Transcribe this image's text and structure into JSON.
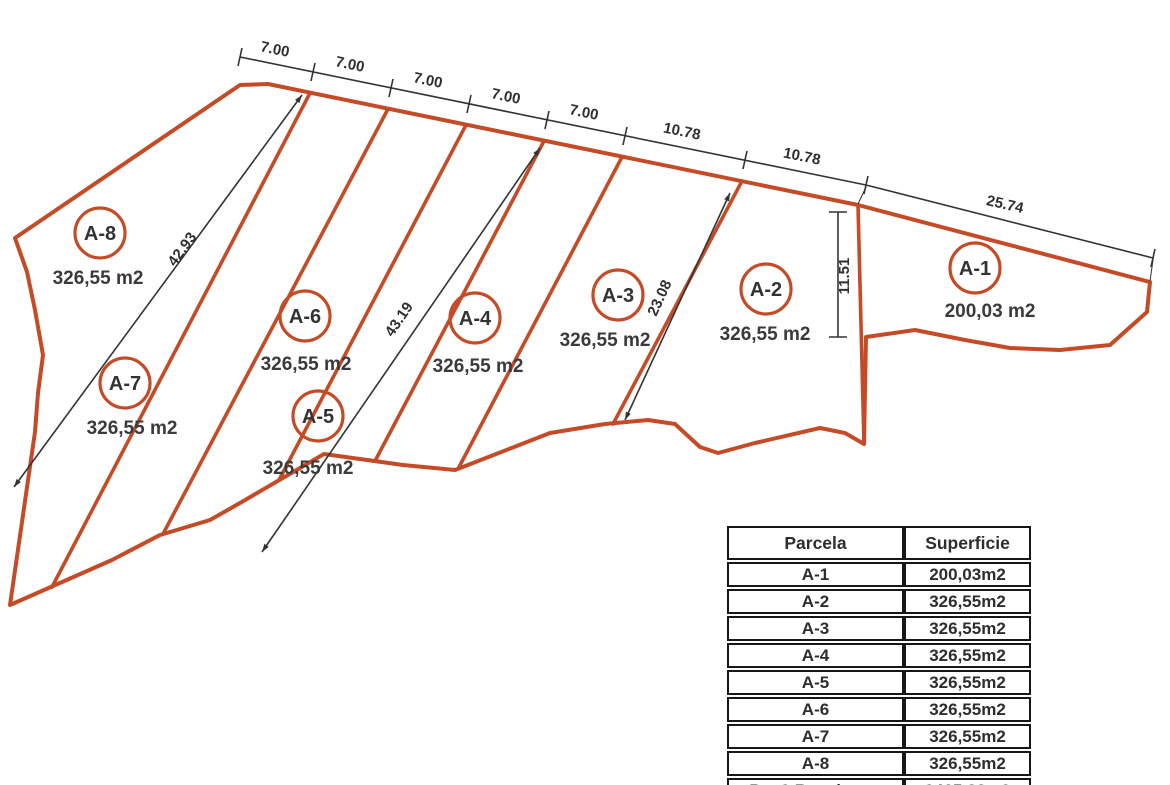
{
  "drawing": {
    "colors": {
      "parcel_line": "#c54b27",
      "dimension_line": "#333333"
    },
    "parcels": [
      {
        "label": "A-1",
        "area": "200,03 m2"
      },
      {
        "label": "A-2",
        "area": "326,55 m2"
      },
      {
        "label": "A-3",
        "area": "326,55 m2"
      },
      {
        "label": "A-4",
        "area": "326,55 m2"
      },
      {
        "label": "A-5",
        "area": "326,55 m2"
      },
      {
        "label": "A-6",
        "area": "326,55 m2"
      },
      {
        "label": "A-7",
        "area": "326,55 m2"
      },
      {
        "label": "A-8",
        "area": "326,55 m2"
      }
    ],
    "top_dims": [
      "7.00",
      "7.00",
      "7.00",
      "7.00",
      "7.00",
      "10.78",
      "10.78",
      "25.74"
    ],
    "diag_dims": [
      "42.93",
      "43.19",
      "23.08",
      "11.51"
    ]
  },
  "table": {
    "headers": [
      "Parcela",
      "Superficie"
    ],
    "rows": [
      [
        "A-1",
        "200,03m2"
      ],
      [
        "A-2",
        "326,55m2"
      ],
      [
        "A-3",
        "326,55m2"
      ],
      [
        "A-4",
        "326,55m2"
      ],
      [
        "A-5",
        "326,55m2"
      ],
      [
        "A-6",
        "326,55m2"
      ],
      [
        "A-7",
        "326,55m2"
      ],
      [
        "A-8",
        "326,55m2"
      ],
      [
        "Par.2 Resultante",
        "2465,88m2"
      ]
    ]
  }
}
